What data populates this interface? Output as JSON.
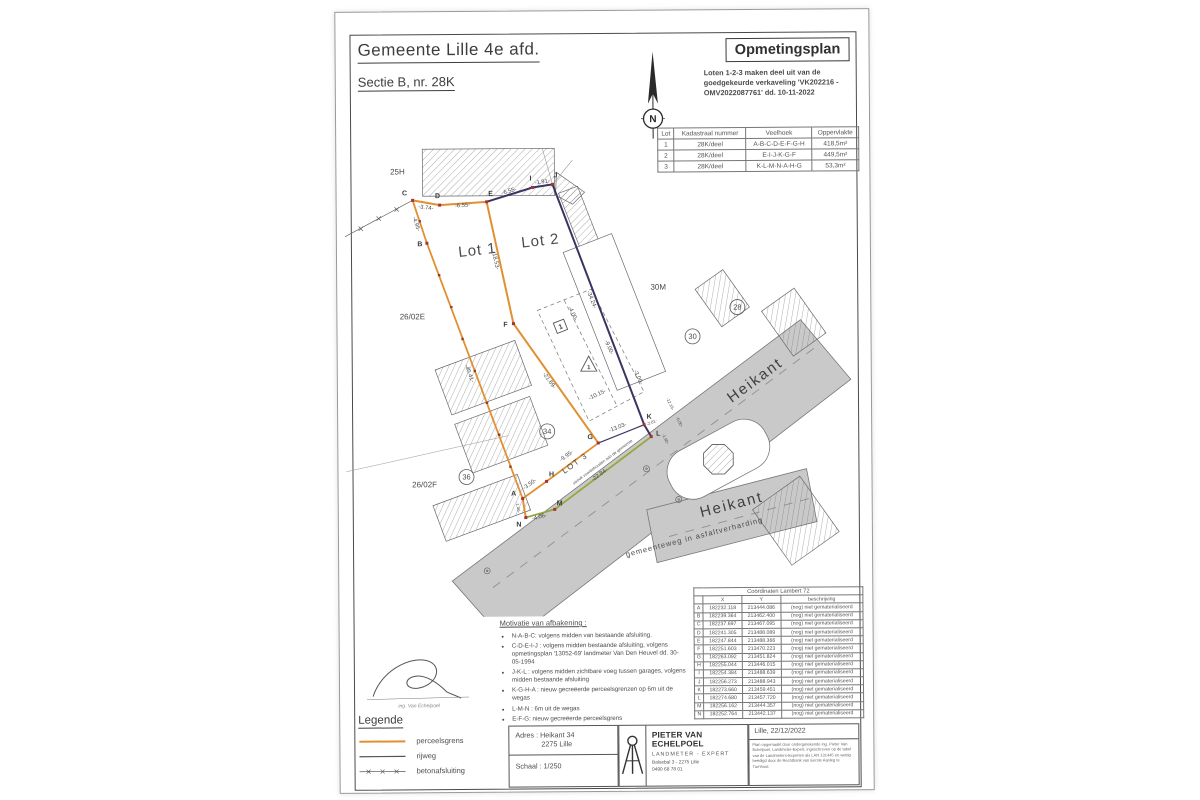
{
  "header": {
    "municipality": "Gemeente Lille 4e afd.",
    "section": "Sectie B, nr. 28K",
    "plan_title": "Opmetingsplan",
    "plan_note": "Loten 1-2-3 maken deel uit van de goedgekeurde verkaveling 'VK202216 - OMV2022087761' dd. 10-11-2022",
    "north_label": "N"
  },
  "lot_table": {
    "headers": [
      "Lot",
      "Kadastraal nummer",
      "Veelhoek",
      "Oppervlakte"
    ],
    "rows": [
      [
        "1",
        "28K/deel",
        "A-B-C-D-E-F-G-H",
        "418,5m²"
      ],
      [
        "2",
        "28K/deel",
        "E-I-J-K-G-F",
        "449,5m²"
      ],
      [
        "3",
        "28K/deel",
        "K-L-M-N-A-H-G",
        "53,3m²"
      ]
    ]
  },
  "coord_table": {
    "title": "Coördinaten Lambert 72",
    "headers": [
      "",
      "X",
      "Y",
      "beschrijving"
    ],
    "rows": [
      [
        "A",
        "182232.118",
        "213444.086",
        "(nog) niet gematerialiseerd"
      ],
      [
        "B",
        "182239.364",
        "213462.400",
        "(nog) niet gematerialiseerd"
      ],
      [
        "C",
        "182237.697",
        "213467.095",
        "(nog) niet gematerialiseerd"
      ],
      [
        "D",
        "182241.305",
        "213488.089",
        "(nog) niet gematerialiseerd"
      ],
      [
        "E",
        "182247.844",
        "213488.366",
        "(nog) niet gematerialiseerd"
      ],
      [
        "F",
        "182251.603",
        "213470.223",
        "(nog) niet gematerialiseerd"
      ],
      [
        "G",
        "182263.092",
        "213451.824",
        "(nog) niet gematerialiseerd"
      ],
      [
        "H",
        "182255.044",
        "213446.015",
        "(nog) niet gematerialiseerd"
      ],
      [
        "I",
        "182254.384",
        "213488.639",
        "(nog) niet gematerialiseerd"
      ],
      [
        "J",
        "182256.273",
        "213488.943",
        "(nog) niet gematerialiseerd"
      ],
      [
        "K",
        "182273.660",
        "213459.451",
        "(nog) niet gematerialiseerd"
      ],
      [
        "L",
        "182274.680",
        "213457.720",
        "(nog) niet gematerialiseerd"
      ],
      [
        "M",
        "182256.162",
        "213444.357",
        "(nog) niet gematerialiseerd"
      ],
      [
        "N",
        "182252.764",
        "213442.137",
        "(nog) niet gematerialiseerd"
      ]
    ]
  },
  "drawing": {
    "lot1": "Lot 1",
    "lot2": "Lot 2",
    "lot3": "LOT 3",
    "parcel_25h": "25H",
    "parcel_26_02e": "26/02E",
    "parcel_26_02f": "26/02F",
    "parcel_30m": "30M",
    "circle_28": "28",
    "circle_30": "30",
    "circle_34": "34",
    "circle_36": "36",
    "road_name": "Heikant",
    "road_desc": "gemeenteweg in asfaltverharding",
    "strip_note": "strook voorbehouden aan de gemeente",
    "building_marker": "1",
    "points": [
      "A",
      "B",
      "C",
      "D",
      "E",
      "F",
      "G",
      "H",
      "I",
      "J",
      "K",
      "L",
      "M",
      "N"
    ],
    "measurements": [
      "-3.74-",
      "-6.55-",
      "-6.55-",
      "-1.91-",
      "-4.95-",
      "-18.53-",
      "-34.24-",
      "-40.41-",
      "-21.69-",
      "-4.00-",
      "-9.00-",
      "-3.00-",
      "-10.15-",
      "-13.03-",
      "-9.95-",
      "-3.50-",
      "-22.84-",
      "-4.06-",
      "-1.40-",
      "-12.16-",
      "-6.00-",
      "-1.90-",
      "-2.01-"
    ]
  },
  "motivation": {
    "title": "Motivatie van afbakening :",
    "items": [
      "N-A-B-C: volgens midden van bestaande afsluiting.",
      "C-D-E-I-J : volgens midden bestaande afsluiting, volgens opmetingsplan '13052-69' landmeter Van Den Heuvel dd. 30-05-1994",
      "J-K-L : volgens midden zichtbare voeg tussen garages, volgens midden bestaande afsluiting",
      "K-G-H-A : nieuw gecreëerde perceelsgrenzen op 6m uit de wegas",
      "L-M-N : 6m uit de wegas",
      "E-F-G: nieuw gecreëerde perceelsgrens"
    ]
  },
  "signature_caption": "ing. Van Echelpoel",
  "legend": {
    "title": "Legende",
    "items": [
      "perceelsgrens",
      "rijweg",
      "betonafsluiting"
    ]
  },
  "titleblock": {
    "address_line1": "Adres : Heikant 34",
    "address_line2": "2275 Lille",
    "scale": "Schaal : 1/250",
    "surveyor_name": "PIETER VAN ECHELPOEL",
    "surveyor_title": "LANDMETER - EXPERT",
    "surveyor_address": "Balsebal 3 - 2275 Lille",
    "surveyor_phone": "0490 68 78 01",
    "place_date": "Lille, 22/12/2022",
    "legal": "Plan opgemaakt door ondergetekende ing. Pieter Van Echelpoel, Landmeter-Expert, ingeschreven op de tabel van de Landmeters-Experten als LAN 131445 en wettig beëdigd door de Rechtbank van Eerste Aanleg te Turnhout."
  },
  "colors": {
    "boundary_orange": "#e09030",
    "boundary_purple": "#3f3263",
    "strip_green": "#9aa63c",
    "point_red": "#a03535",
    "road_gray": "#c9c9c9"
  }
}
